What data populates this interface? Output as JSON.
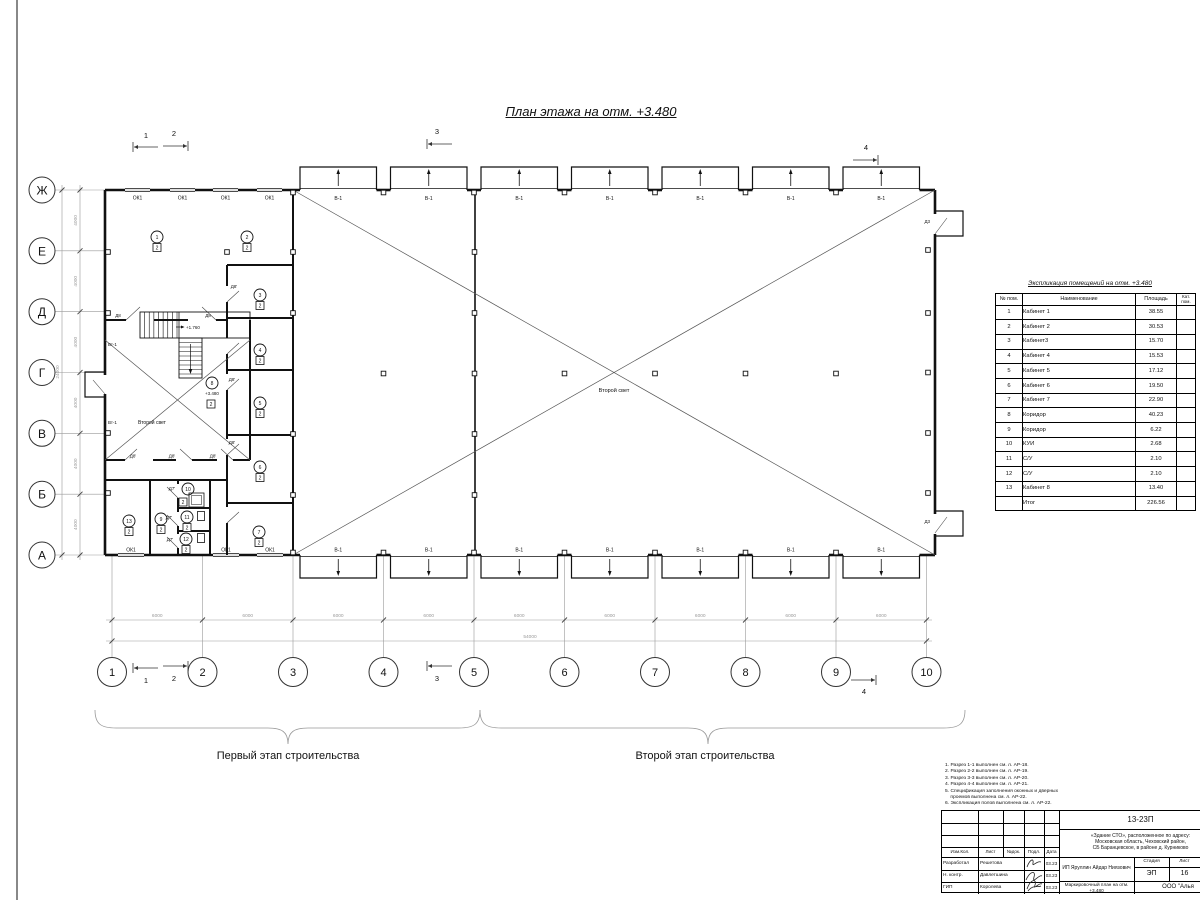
{
  "title": "План этажа на отм. +3.480",
  "axes": {
    "rows": [
      "Ж",
      "Е",
      "Д",
      "Г",
      "В",
      "Б",
      "А"
    ],
    "cols": [
      "1",
      "2",
      "3",
      "4",
      "5",
      "6",
      "7",
      "8",
      "9",
      "10"
    ]
  },
  "dimensions": {
    "bay_width": "6000",
    "total_width": "54000",
    "bay_height": "4000",
    "total_height": "24000"
  },
  "sections": [
    "1",
    "2",
    "3",
    "4"
  ],
  "plan_labels": {
    "window": "ОК1",
    "gate": "В-1",
    "door_d8": "Д8",
    "door_d8a": "Д8'",
    "door_d7a": "Д7'",
    "door_d3": "Д3",
    "vt": "Вт-1",
    "second_light": "Второй свет",
    "stair_level": "+1.760",
    "floor_level": "+3.480",
    "category": "2"
  },
  "room_numbers": [
    "1",
    "2",
    "3",
    "4",
    "5",
    "6",
    "7",
    "8",
    "9",
    "10",
    "11",
    "12",
    "13"
  ],
  "stages": {
    "first": "Первый этап строительства",
    "second": "Второй этап строительства"
  },
  "explication": {
    "title": "Экспликация помещений на отм. +3.480",
    "col_num": "№ пом.",
    "col_name": "Наименование",
    "col_area": "Площадь",
    "col_cat": "Кат. пом.",
    "rows": [
      {
        "num": "1",
        "name": "Кабинет 1",
        "area": "38.55"
      },
      {
        "num": "2",
        "name": "Кабинет 2",
        "area": "30.53"
      },
      {
        "num": "3",
        "name": "Кабинет3",
        "area": "15.70"
      },
      {
        "num": "4",
        "name": "Кабинет 4",
        "area": "15.53"
      },
      {
        "num": "5",
        "name": "Кабинет 5",
        "area": "17.12"
      },
      {
        "num": "6",
        "name": "Кабинет 6",
        "area": "19.50"
      },
      {
        "num": "7",
        "name": "Кабинет 7",
        "area": "22.90"
      },
      {
        "num": "8",
        "name": "Коридор",
        "area": "40.23"
      },
      {
        "num": "9",
        "name": "Коридор",
        "area": "6.22"
      },
      {
        "num": "10",
        "name": "КУИ",
        "area": "2.68"
      },
      {
        "num": "11",
        "name": "С/У",
        "area": "2.10"
      },
      {
        "num": "12",
        "name": "С/У",
        "area": "2.10"
      },
      {
        "num": "13",
        "name": "Кабинет 8",
        "area": "13.40"
      }
    ],
    "total_label": "Итог",
    "total_area": "226.56"
  },
  "notes": [
    "1. Разрез 1-1 выполнен см. л. АР-18.",
    "2. Разрез 2-2 выполнен см. л. АР-19.",
    "3. Разрез 3-3 выполнен см. л. АР-20.",
    "4. Разрез 4-4 выполнен см. л. АР-21.",
    "5. Спецификация заполнения оконных и дверных",
    "    проемов выполнена см. л. АР-22.",
    "6. Экспликация полов выполнена см. л. АР-22."
  ],
  "stamp": {
    "doc_number": "13-23П",
    "object_line1": "«Здание СТО», расположенное по адресу:",
    "object_line2": "Московская область, Чеховский район,",
    "object_line3": "СБ Баранцевское, в районе д. Курниково",
    "client": "ИП Яруллин Айдар Ниязович",
    "sheet_title": "Маркировочный план на отм. +3.480",
    "org": "ООО \"Алья",
    "h_izm_kol": "Изм.Кол.",
    "h_list": "Лист",
    "h_doc": "№док.",
    "h_podp": "Подл.",
    "h_date": "Дата",
    "stage_label": "Стадия",
    "sheet_label": "Лист",
    "stage": "ЭП",
    "sheet": "16",
    "roles": [
      {
        "role": "Разработал",
        "name": "Решетова",
        "date": "03.23"
      },
      {
        "role": "Н. контр.",
        "name": "Давлетшина",
        "date": "03.23"
      },
      {
        "role": "ГИП",
        "name": "Королева",
        "date": "03.23"
      }
    ]
  }
}
